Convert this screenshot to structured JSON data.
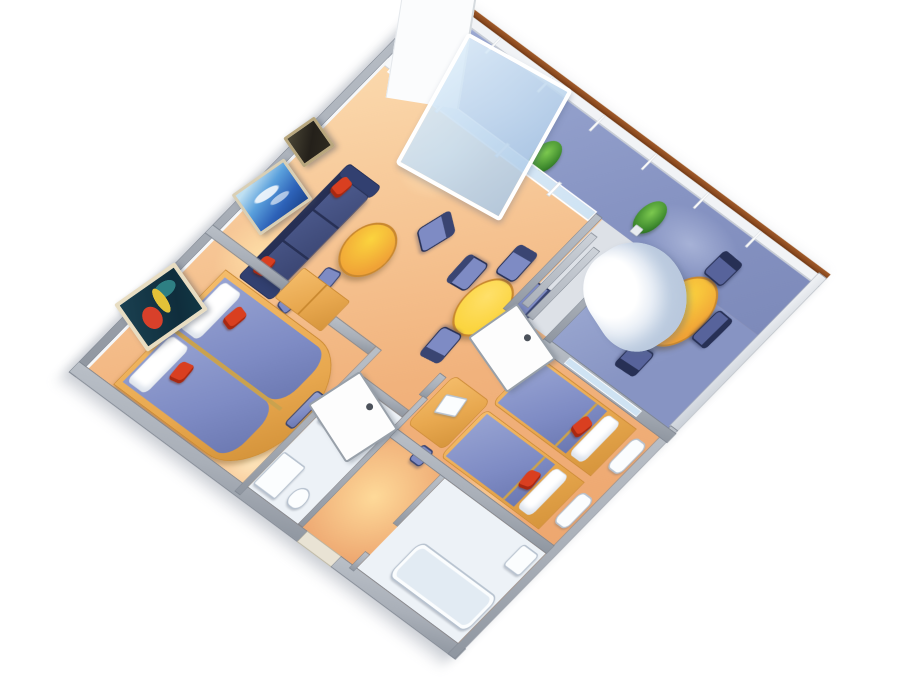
{
  "meta": {
    "description": "3D cutaway floor plan rendering of a two-bedroom suite with a long private balcony, viewed from above at an angle on a white background",
    "background": "#ffffff",
    "visible_text": ""
  },
  "palette": {
    "wall": "#a9afb8",
    "wall-dark": "#7e8590",
    "wall-face": "#f5f7f9",
    "floor-light": "#fbd9ad",
    "floor-mid": "#f1b27c",
    "floor-deep": "#eca26a",
    "floor-glow": "#ffe9c0",
    "balcony-blue": "#8794c3",
    "balcony-blue-light": "#9facd4",
    "rail-white": "#f1f3f6",
    "rail-cap": "#8b4a20",
    "navy": "#3a4572",
    "navy-dark": "#273055",
    "periwinkle": "#7e8bc4",
    "periwinkle-light": "#97a3d2",
    "red": "#d93f20",
    "table-orange": "#f0a236",
    "table-yellow": "#fbd43e",
    "wood": "#e8a84f",
    "wood-dark": "#c9882f",
    "gold": "#caa24e",
    "plant-green": "#3e8a2e",
    "plant-dark": "#1f5c1a",
    "glass": "#cfe3f3",
    "bath-floor": "#edf2f7",
    "fixture": "#fbfdfe",
    "fixture-edge": "#b7c2cf",
    "closet": "#dde1e7",
    "art-teal": "#1a4050",
    "art-blue": "#2d62b8",
    "art-sky": "#bfe0f2",
    "art-dark": "#24201a",
    "art-red": "#d8402a",
    "art-gold": "#e3c238",
    "frame": "#d9cfb5",
    "door-white": "#fdfdfd"
  },
  "rooms": [
    {
      "name": "Balcony",
      "floor_color": "#8794c3",
      "items": [
        "round dining table",
        "4 navy dining chairs",
        "2 potted plants",
        "white railing with wood cap",
        "end wall"
      ]
    },
    {
      "name": "Living room",
      "floor_color": "#f1b27c",
      "items": [
        "navy sofa with 2 red cushions",
        "round coffee table",
        "armchair",
        "2 blue ottomans",
        "round game table",
        "4 periwinkle chairs",
        "seascape painting",
        "dark painting",
        "sliding glass balcony door"
      ]
    },
    {
      "name": "Master bedroom",
      "floor_color": "#f1b27c",
      "items": [
        "double bed with split periwinkle mattresses",
        "2 white pillows",
        "2 red pillows",
        "wood wardrobe",
        "bedside bench",
        "abstract wall painting",
        "open door"
      ]
    },
    {
      "name": "Second bedroom",
      "floor_color": "#f1b27c",
      "items": [
        "2 twin beds with red pillows",
        "2 white nightstands",
        "wood vanity desk",
        "television",
        "stool",
        "closet partition",
        "white drapes at balcony window"
      ]
    },
    {
      "name": "Bathroom 1",
      "floor_color": "#edf2f7",
      "items": [
        "shower",
        "sink",
        "toilet",
        "open door"
      ]
    },
    {
      "name": "Bathroom 2",
      "floor_color": "#edf2f7",
      "items": [
        "bathtub",
        "sink"
      ]
    },
    {
      "name": "Entry corridor",
      "floor_color": "#f1b27c",
      "items": [
        "entry door opening"
      ]
    }
  ],
  "counts": {
    "plants": 2,
    "balcony_dining_chairs": 4,
    "game_table_chairs": 4,
    "paintings": 3,
    "red_cushions_total": 6,
    "beds": 3,
    "bathrooms": 2,
    "round_tables": 3
  }
}
